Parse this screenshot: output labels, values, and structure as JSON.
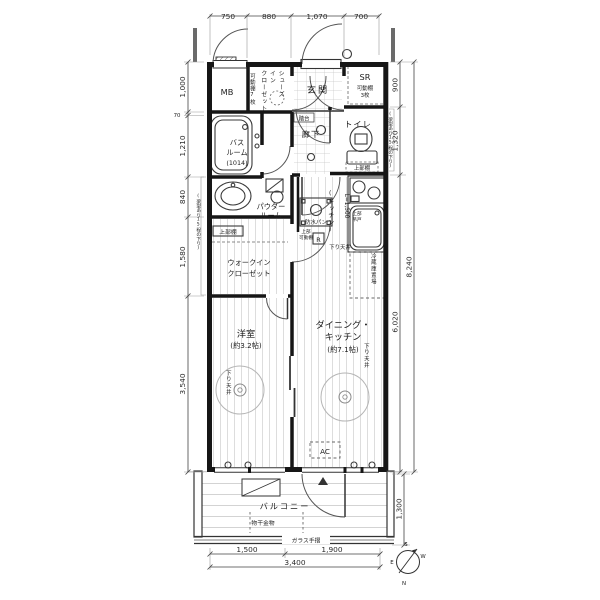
{
  "plan": {
    "dims": {
      "top": [
        "750",
        "880",
        "1,070",
        "700"
      ],
      "left": [
        "1,000",
        "70",
        "1,210",
        "840",
        "1,580",
        "3,540"
      ],
      "right": [
        "900",
        "1,320",
        "6,020",
        "8,240"
      ],
      "bottom": [
        "1,500",
        "1,900",
        "3,400"
      ],
      "balcony": "1,300"
    },
    "labels": {
      "mb": "MB",
      "sic": "シューズ\nイン\nクローゼット",
      "sic_shelf": "可動棚7枚",
      "genkan": "玄関",
      "fumidai": "踏台",
      "sr": "SR",
      "sr_shelf1": "可動棚",
      "sr_shelf2": "3枚",
      "hall": "廊下",
      "toilet": "トイレ",
      "toilet_shelf": "上部棚",
      "bath1": "バス",
      "bath2": "ルーム",
      "bath3": "(1014)",
      "powder1": "パウダー",
      "powder2": "ルーム",
      "pan": "防水パン",
      "pan_shelf1": "上部",
      "pan_shelf2": "可動棚",
      "wic_shelf": "上部棚",
      "wic1": "ウォークイン",
      "wic2": "クローゼット",
      "bedroom1": "洋室",
      "bedroom2": "(約3.2帖)",
      "dk1": "ダイニング・",
      "dk2": "キッチン",
      "dk3": "(約7.1帖)",
      "kitchen": "(キッチン)",
      "kitchen_l": "L=1,500",
      "cab1": "上部",
      "cab2": "吊戸",
      "fridge": "冷蔵庫置場",
      "r": "R",
      "ac": "AC",
      "down_ceiling": "下り天井",
      "beam_note": "(梁型あり15程の下り)",
      "balcony": "バルコニー",
      "hook": "物干金物",
      "rail": "ガラス手摺"
    },
    "compass": {
      "n": "N",
      "s": "S",
      "e": "E",
      "w": "W"
    }
  }
}
